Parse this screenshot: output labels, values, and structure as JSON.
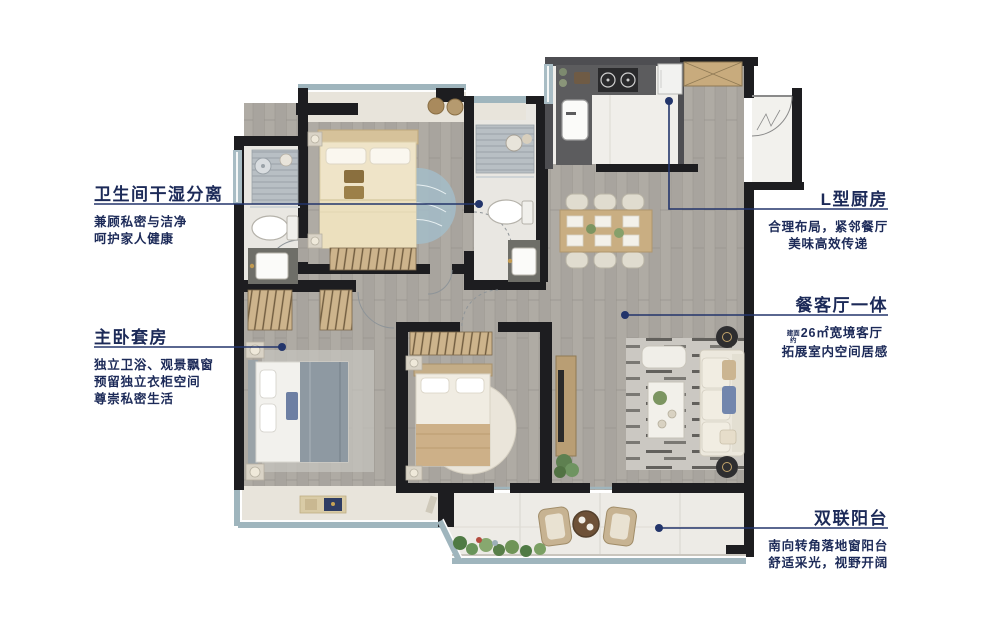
{
  "colors": {
    "title_navy": "#1c2a58",
    "line_navy": "#23356b",
    "wall_black": "#1d1d20",
    "wood_floor": "#a8a49e",
    "tile_light": "#edebe6",
    "window_blue": "#9fb5bd"
  },
  "callouts": {
    "left": [
      {
        "title": "卫生间干湿分离",
        "lines": [
          "兼顾私密与洁净",
          "呵护家人健康"
        ]
      },
      {
        "title": "主卧套房",
        "lines": [
          "独立卫浴、观景飘窗",
          "预留独立衣柜空间",
          "尊崇私密生活"
        ]
      }
    ],
    "right": [
      {
        "title": "L型厨房",
        "lines": [
          "合理布局，紧邻餐厅",
          "美味高效传递"
        ]
      },
      {
        "title": "餐客厅一体",
        "area_prefix_top": "建面",
        "area_prefix_bottom": "约",
        "area_text": "26㎡宽境客厅",
        "lines": [
          "拓展室内空间居感"
        ]
      },
      {
        "title": "双联阳台",
        "lines": [
          "南向转角落地窗阳台",
          "舒适采光，视野开阔"
        ]
      }
    ]
  }
}
